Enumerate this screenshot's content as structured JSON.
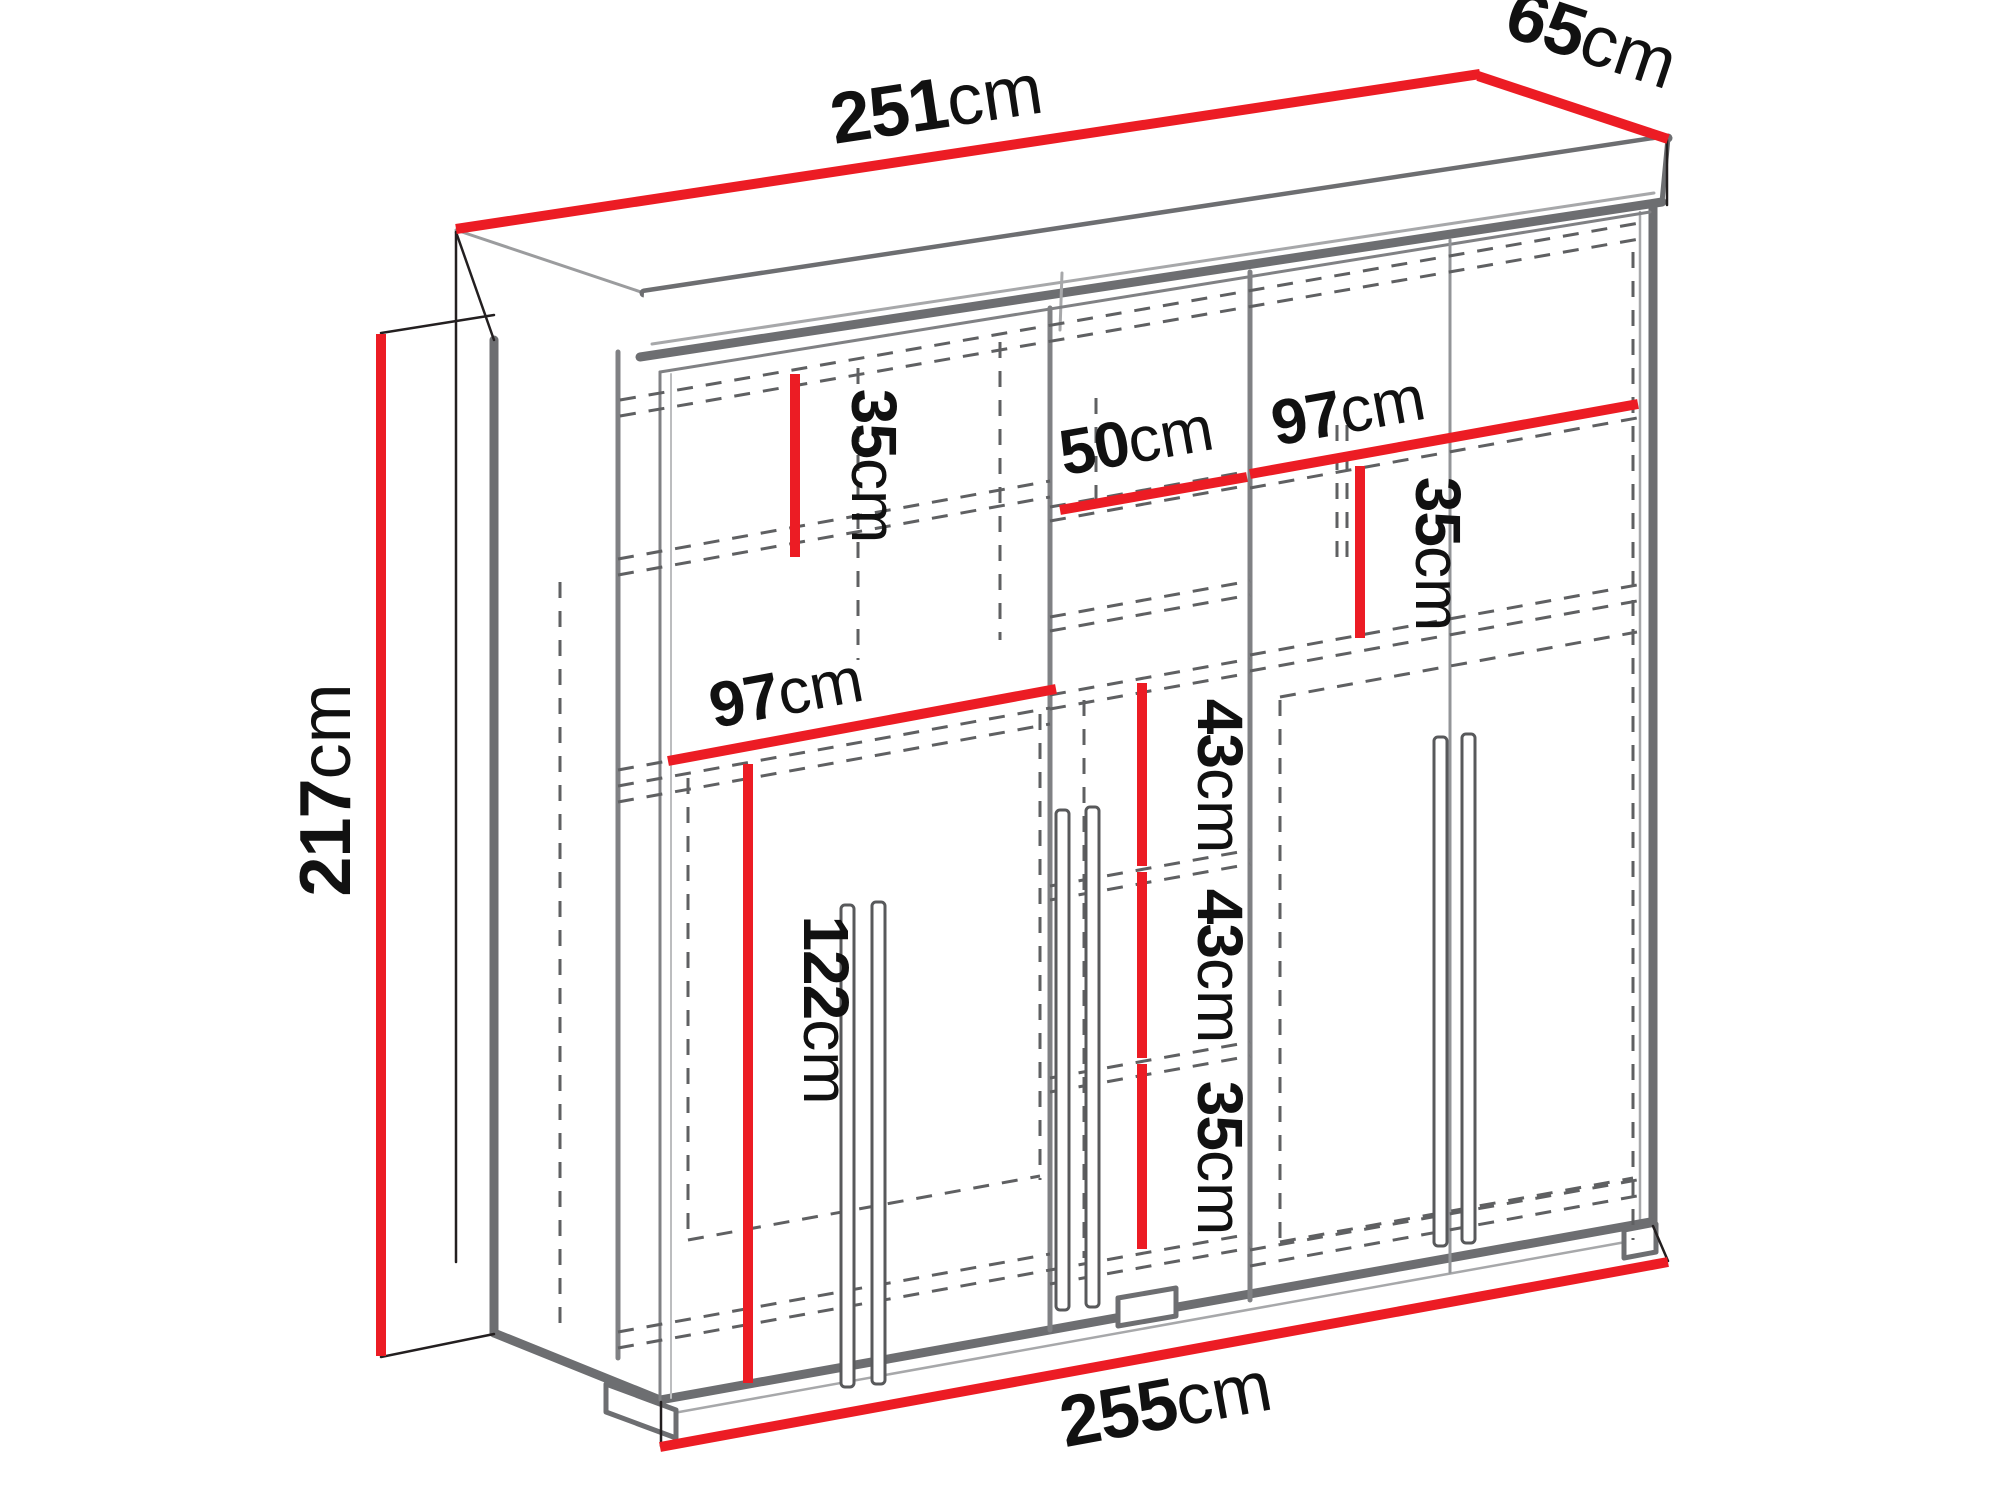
{
  "diagram": {
    "type": "furniture-dimension-drawing",
    "subject": "three-door sliding wardrobe with interior shelves",
    "unit": "cm",
    "colors": {
      "dimension_line": "#ec1c24",
      "outline_dark": "#6d6e71",
      "outline_thin": "#231f20",
      "dashed_line": "#5f6062",
      "background": "#ffffff"
    },
    "dims": {
      "width_top": {
        "value": "251",
        "unit": "cm"
      },
      "depth_top": {
        "value": "65",
        "unit": "cm"
      },
      "height_left": {
        "value": "217",
        "unit": "cm"
      },
      "width_bottom": {
        "value": "255",
        "unit": "cm"
      },
      "left_top_shelf": {
        "value": "35",
        "unit": "cm"
      },
      "middle_width": {
        "value": "50",
        "unit": "cm"
      },
      "right_width": {
        "value": "97",
        "unit": "cm"
      },
      "right_top_shelf": {
        "value": "35",
        "unit": "cm"
      },
      "left_width": {
        "value": "97",
        "unit": "cm"
      },
      "left_hanging_height": {
        "value": "122",
        "unit": "cm"
      },
      "middle_section_1": {
        "value": "43",
        "unit": "cm"
      },
      "middle_section_2": {
        "value": "43",
        "unit": "cm"
      },
      "middle_section_3": {
        "value": "35",
        "unit": "cm"
      }
    }
  }
}
